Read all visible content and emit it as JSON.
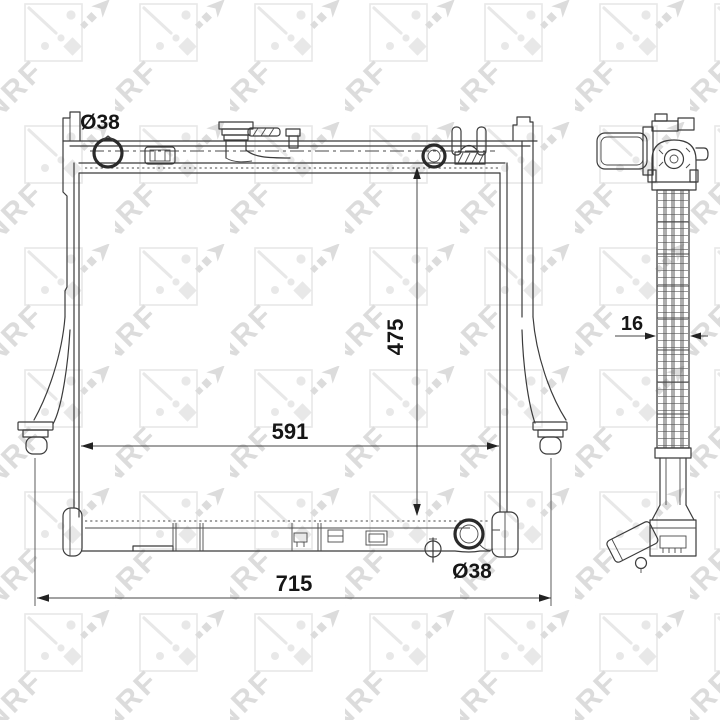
{
  "watermark": {
    "text": "NRF",
    "color_light": "#e8e8e8",
    "color_bold": "#dcdcdc"
  },
  "drawing": {
    "line_color": "#3b3b3b",
    "text_color": "#161616"
  },
  "dimensions": {
    "inlet_diameter_top": "Ø38",
    "core_height": "475",
    "core_width": "591",
    "overall_width": "715",
    "outlet_diameter_bottom": "Ø38",
    "core_thickness_side": "16"
  }
}
